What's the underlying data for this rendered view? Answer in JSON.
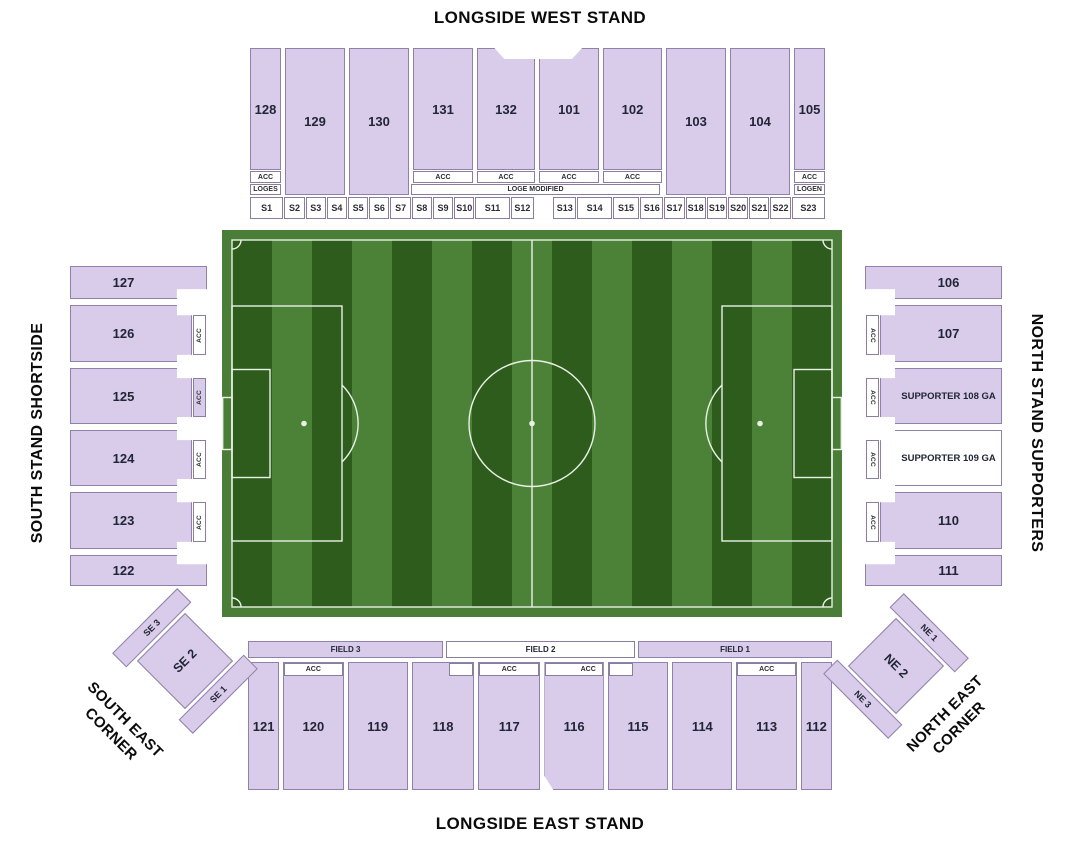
{
  "titles": {
    "west": "LONGSIDE WEST STAND",
    "east": "LONGSIDE EAST STAND",
    "south": "SOUTH STAND SHORTSIDE",
    "north": "NORTH STAND SUPPORTERS"
  },
  "labels": {
    "acc": "ACC",
    "loges": "LOGES",
    "loge_modified": "LOGE MODIFIED",
    "logen": "LOGEN"
  },
  "west_stand": {
    "sections": [
      "128",
      "129",
      "130",
      "131",
      "132",
      "101",
      "102",
      "103",
      "104",
      "105"
    ],
    "suites": [
      "S1",
      "S2",
      "S3",
      "S4",
      "S5",
      "S6",
      "S7",
      "S8",
      "S9",
      "S10",
      "S11",
      "S12",
      "S13",
      "S14",
      "S15",
      "S16",
      "S17",
      "S18",
      "S19",
      "S20",
      "S21",
      "S22",
      "S23"
    ]
  },
  "south_stand": {
    "sections": [
      "127",
      "126",
      "125",
      "124",
      "123",
      "122"
    ]
  },
  "north_stand": {
    "sections": [
      "106",
      "107",
      "SUPPORTER 108 GA",
      "SUPPORTER 109 GA",
      "110",
      "111"
    ]
  },
  "east_stand": {
    "fields": [
      "FIELD 3",
      "FIELD 2",
      "FIELD 1"
    ],
    "sections": [
      "121",
      "120",
      "119",
      "118",
      "117",
      "116",
      "115",
      "114",
      "113",
      "112"
    ]
  },
  "se_corner": {
    "sections": [
      "SE 3",
      "SE 2",
      "SE 1"
    ],
    "label": "SOUTH EAST\nCORNER"
  },
  "ne_corner": {
    "sections": [
      "NE 1",
      "NE 2",
      "NE 3"
    ],
    "label": "NORTH EAST\nCORNER"
  },
  "theme": {
    "section-fill": "#d9cbea",
    "section-border": "#8f81a8",
    "pitch-frame": "#4a7d37",
    "stripe-dark": "#2d5c1d",
    "stripe-light": "#4c8138",
    "pitch-line": "#e9f1e5"
  }
}
